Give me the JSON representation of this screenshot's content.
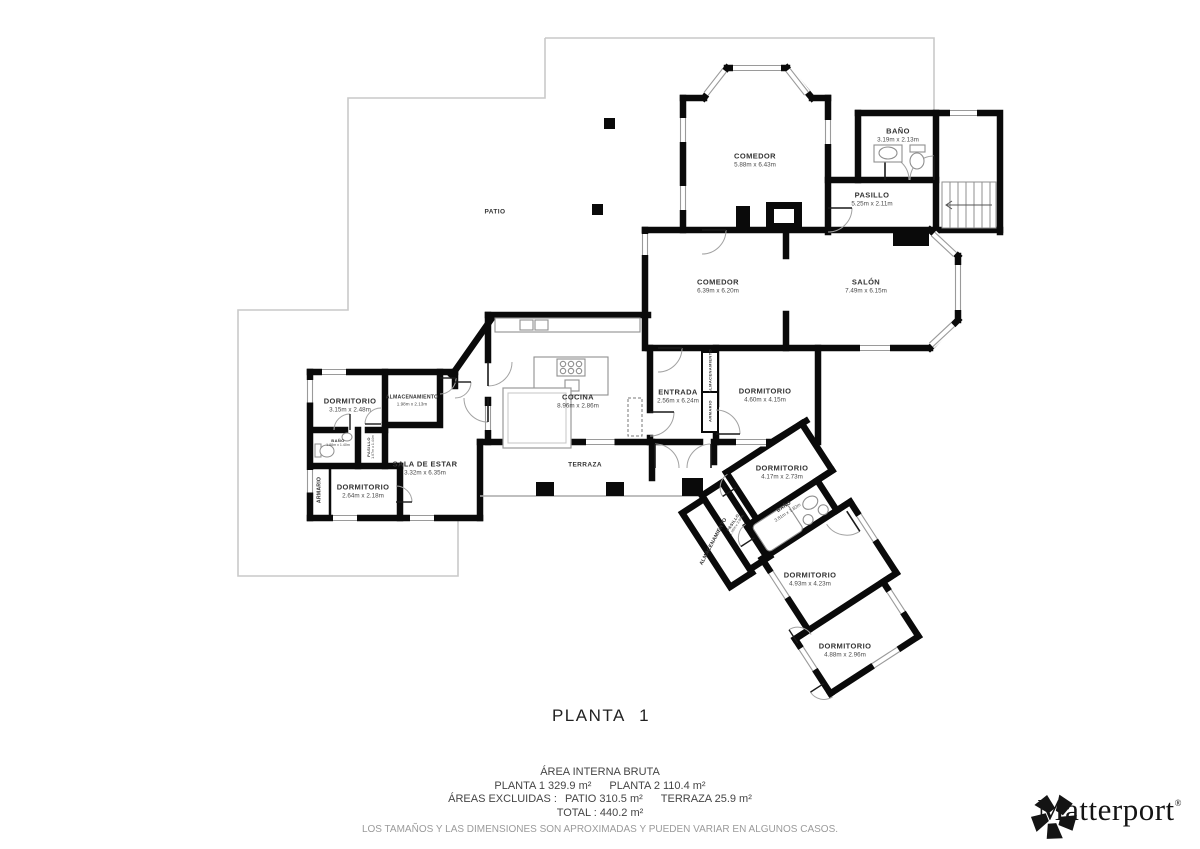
{
  "title": "PLANTA 1",
  "patio": {
    "label": "PATIO"
  },
  "terraza": {
    "label": "TERRAZA"
  },
  "rooms": {
    "bano_superior": {
      "name": "BAÑO",
      "dims": "3.19m x 2.13m"
    },
    "pasillo_superior": {
      "name": "PASILLO",
      "dims": "5.25m x 2.11m"
    },
    "comedor_superior": {
      "name": "COMEDOR",
      "dims": "5.88m x 6.43m"
    },
    "comedor": {
      "name": "COMEDOR",
      "dims": "6.39m x 6.20m"
    },
    "salon": {
      "name": "SALÓN",
      "dims": "7.49m x 6.15m"
    },
    "cocina": {
      "name": "COCINA",
      "dims": "8.96m x 2.86m"
    },
    "entrada": {
      "name": "ENTRADA",
      "dims": "2.56m x 6.24m"
    },
    "dormitorio_principal": {
      "name": "DORMITORIO",
      "dims": "4.60m x 4.15m"
    },
    "dormitorio_izq_1": {
      "name": "DORMITORIO",
      "dims": "3.15m x 2.48m"
    },
    "almacenamiento_izq": {
      "name": "ALMACENAMIENTO",
      "dims": "1.98m x 2.13m"
    },
    "bano_izq": {
      "name": "BAÑO",
      "dims": "1.88m x 1.40m"
    },
    "pasillo_izq": {
      "name": "PASILLO",
      "dims": "1.07m x 1.44m"
    },
    "dormitorio_izq_2": {
      "name": "DORMITORIO",
      "dims": "2.64m x 2.18m"
    },
    "sala_de_estar": {
      "name": "SALA DE ESTAR",
      "dims": "3.32m x 6.35m"
    },
    "dormitorio_wing_1": {
      "name": "DORMITORIO",
      "dims": "4.17m x 2.73m"
    },
    "bano_wing": {
      "name": "BAÑO",
      "dims": "3.81m x 1.82m"
    },
    "pasillo_wing": {
      "name": "PASILLO",
      "dims": "1.16m x 3.96m"
    },
    "dormitorio_wing_2": {
      "name": "DORMITORIO",
      "dims": "4.93m x 4.23m"
    },
    "dormitorio_wing_3": {
      "name": "DORMITORIO",
      "dims": "4.88m x 2.96m"
    }
  },
  "closets": {
    "armario_izq": "ARMARIO",
    "entrada_almacenamiento": "ALMACENAMIENTO",
    "entrada_armario": "ARMARIO",
    "almacenamiento_wing": "ALMACENAMIENTO"
  },
  "summary": {
    "area_title": "ÁREA INTERNA BRUTA",
    "planta1": "PLANTA 1 329.9 m²",
    "planta2": "PLANTA 2 110.4 m²",
    "excluidas": "ÁREAS EXCLUIDAS :",
    "patio_area": "PATIO 310.5 m²",
    "terraza_area": "TERRAZA 25.9 m²",
    "total": "TOTAL :  440.2 m²",
    "disclaimer": "LOS TAMAÑOS Y LAS DIMENSIONES SON APROXIMADAS Y PUEDEN VARIAR EN ALGUNOS CASOS."
  },
  "colors": {
    "wall": "#0a0a0a",
    "patio_line": "#c9c9c9",
    "fixture": "#8f8f8f",
    "text": "#3c3c3c"
  },
  "logo": {
    "text": "Matterport",
    "reg": "®"
  }
}
